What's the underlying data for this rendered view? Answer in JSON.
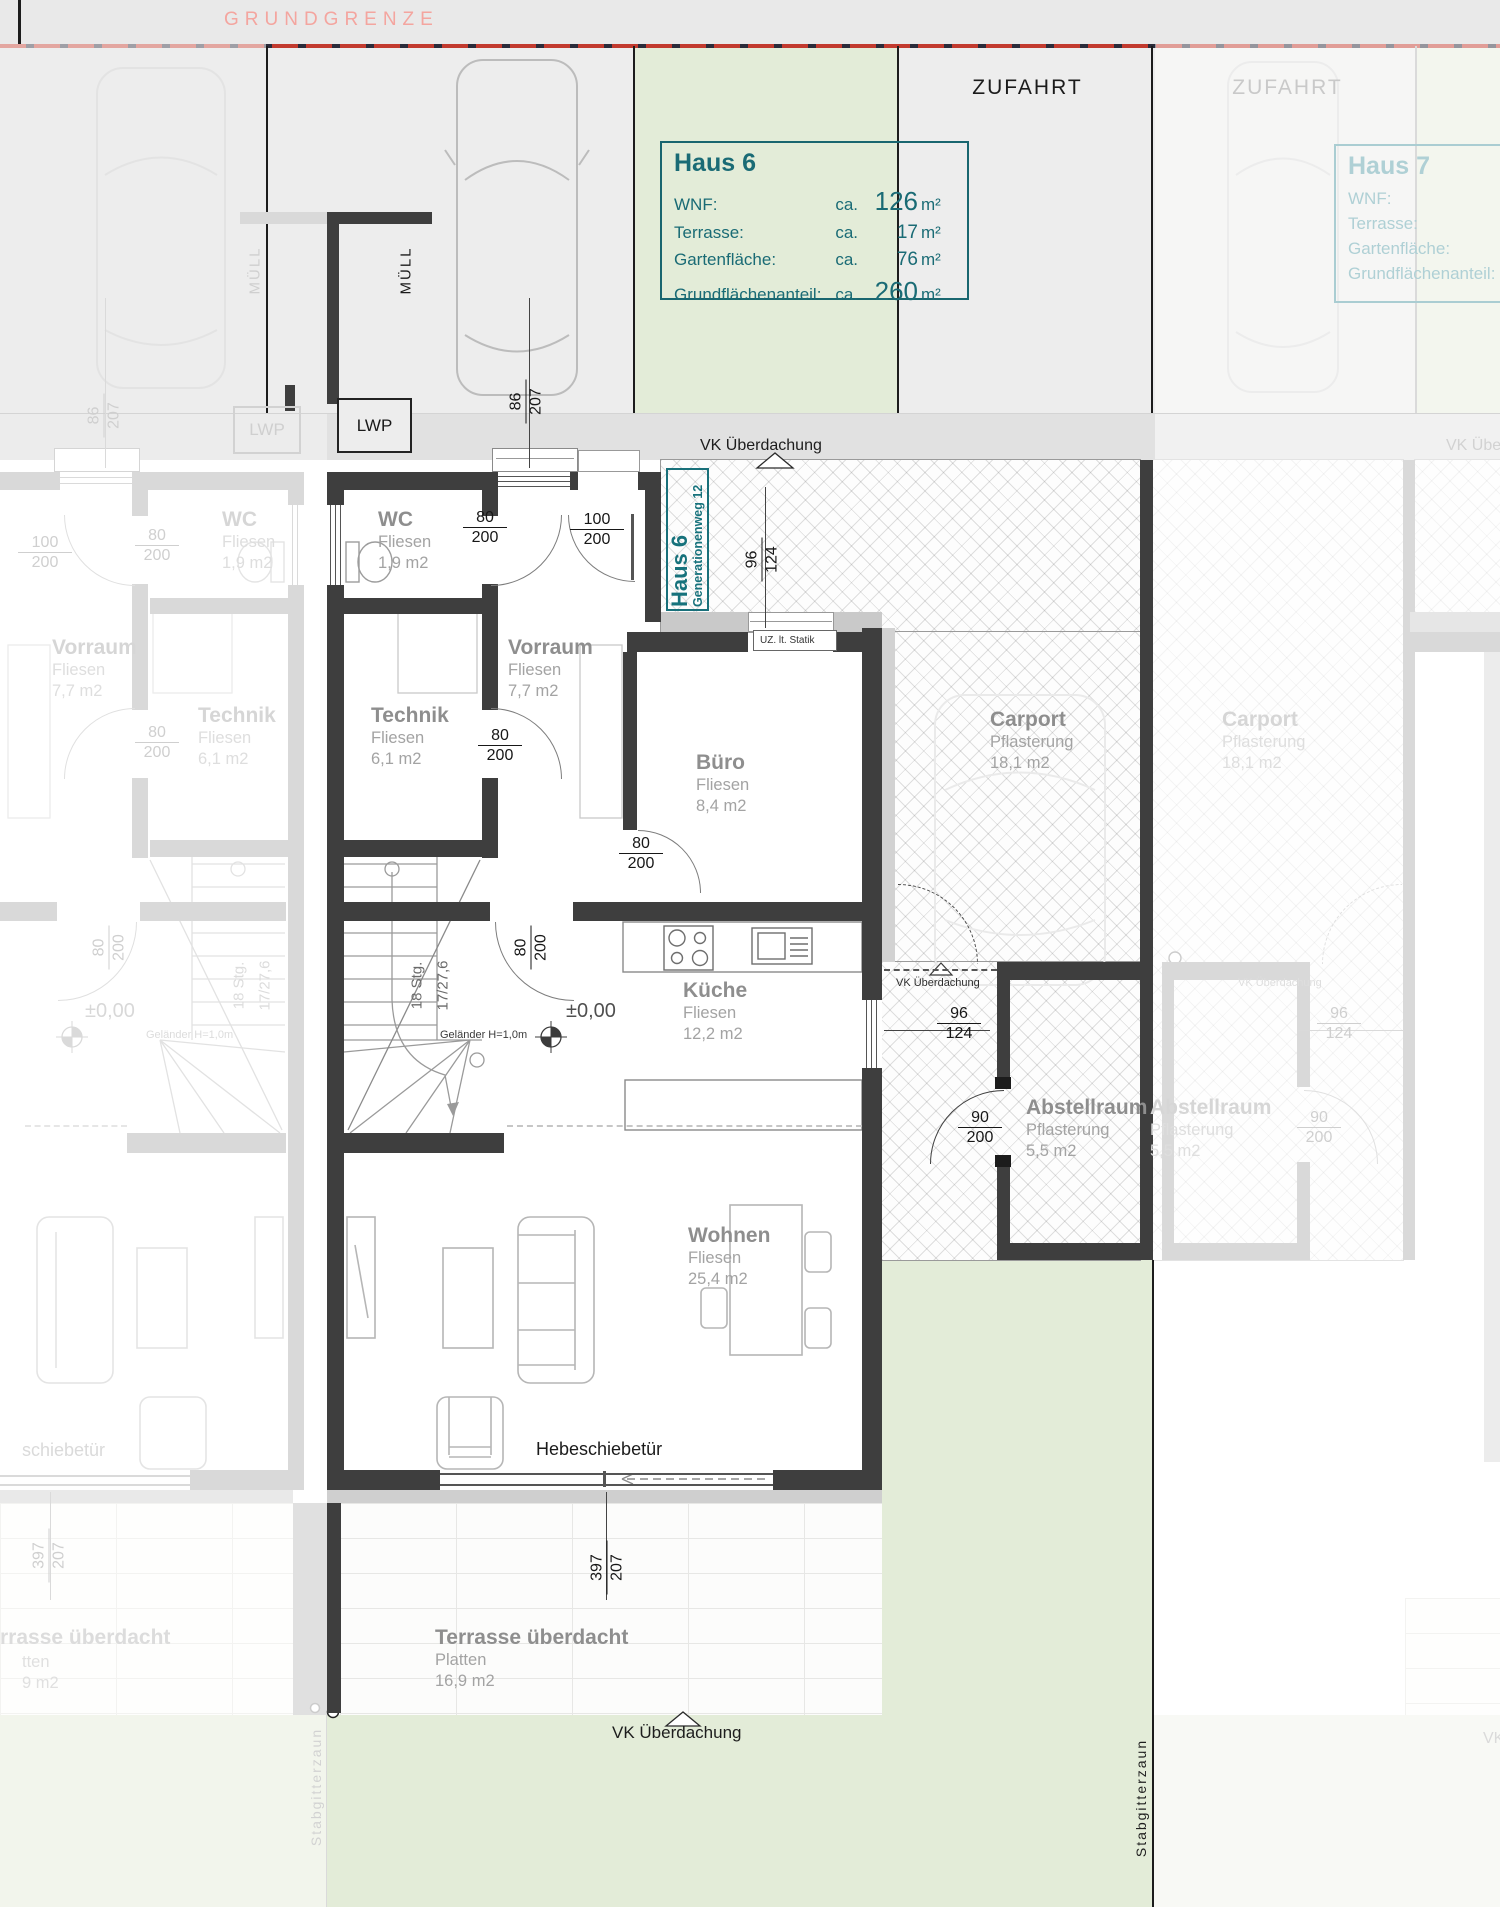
{
  "site": {
    "grundgrenze": "GRUNDGRENZE",
    "zufahrt": "ZUFAHRT",
    "muell": "MÜLL",
    "lwp": "LWP",
    "stabgitterzaun": "Stabgitterzaun"
  },
  "annotations": {
    "vk": "VK Überdachung",
    "uz": "UZ. lt. Statik",
    "level": "±0,00",
    "gelaender": "Geländer H=1,0m",
    "stairs1": "18 Stg.",
    "stairs2": "17/27,6",
    "hebeschiebetuer": "Hebeschiebetür"
  },
  "address_tag": {
    "house": "Haus 6",
    "street": "Generationenweg 12"
  },
  "info_box_h6": {
    "title": "Haus 6",
    "rows": [
      {
        "label": "WNF:",
        "ca": "ca.",
        "value": "126",
        "unit": "m²"
      },
      {
        "label": "Terrasse:",
        "ca": "ca.",
        "value": "17",
        "unit": "m²"
      },
      {
        "label": "Gartenfläche:",
        "ca": "ca.",
        "value": "76",
        "unit": "m²"
      },
      {
        "label": "Grundflächenanteil:",
        "ca": "ca.",
        "value": "260",
        "unit": "m²"
      }
    ]
  },
  "info_box_h7": {
    "title": "Haus 7",
    "rows": [
      {
        "label": "WNF:"
      },
      {
        "label": "Terrasse:"
      },
      {
        "label": "Gartenfläche:"
      },
      {
        "label": "Grundflächenanteil:"
      }
    ]
  },
  "rooms": {
    "wc": {
      "name": "WC",
      "finish": "Fliesen",
      "area": "1,9 m2"
    },
    "vorraum": {
      "name": "Vorraum",
      "finish": "Fliesen",
      "area": "7,7 m2"
    },
    "technik": {
      "name": "Technik",
      "finish": "Fliesen",
      "area": "6,1 m2"
    },
    "buero": {
      "name": "Büro",
      "finish": "Fliesen",
      "area": "8,4 m2"
    },
    "kueche": {
      "name": "Küche",
      "finish": "Fliesen",
      "area": "12,2 m2"
    },
    "wohnen": {
      "name": "Wohnen",
      "finish": "Fliesen",
      "area": "25,4 m2"
    },
    "carport": {
      "name": "Carport",
      "finish": "Pflasterung",
      "area": "18,1 m2"
    },
    "abstellraum": {
      "name": "Abstellraum",
      "finish": "Pflasterung",
      "area": "5,5 m2"
    },
    "terrasse": {
      "name": "Terrasse überdacht",
      "finish": "Platten",
      "area": "16,9 m2"
    }
  },
  "faded_partials": {
    "terrasse_name": "rrasse überdacht",
    "terrasse_finish": "tten",
    "terrasse_area": "9 m2",
    "schiebetuer": "schiebetür"
  },
  "dims": {
    "w86_207": {
      "n": "86",
      "d": "207"
    },
    "w80_200": {
      "n": "80",
      "d": "200"
    },
    "w100_200": {
      "n": "100",
      "d": "200"
    },
    "w96_124": {
      "n": "96",
      "d": "124"
    },
    "w90_200": {
      "n": "90",
      "d": "200"
    },
    "w397_207": {
      "n": "397",
      "d": "207"
    }
  },
  "colors": {
    "teal": "#1a6b75",
    "faded_teal": "#aacdd2",
    "boundary_pink": "#f4a59f",
    "dash_red": "#c23a2e",
    "garden_green": "#e3ecd8",
    "wall_dark": "#3e3e3e"
  }
}
